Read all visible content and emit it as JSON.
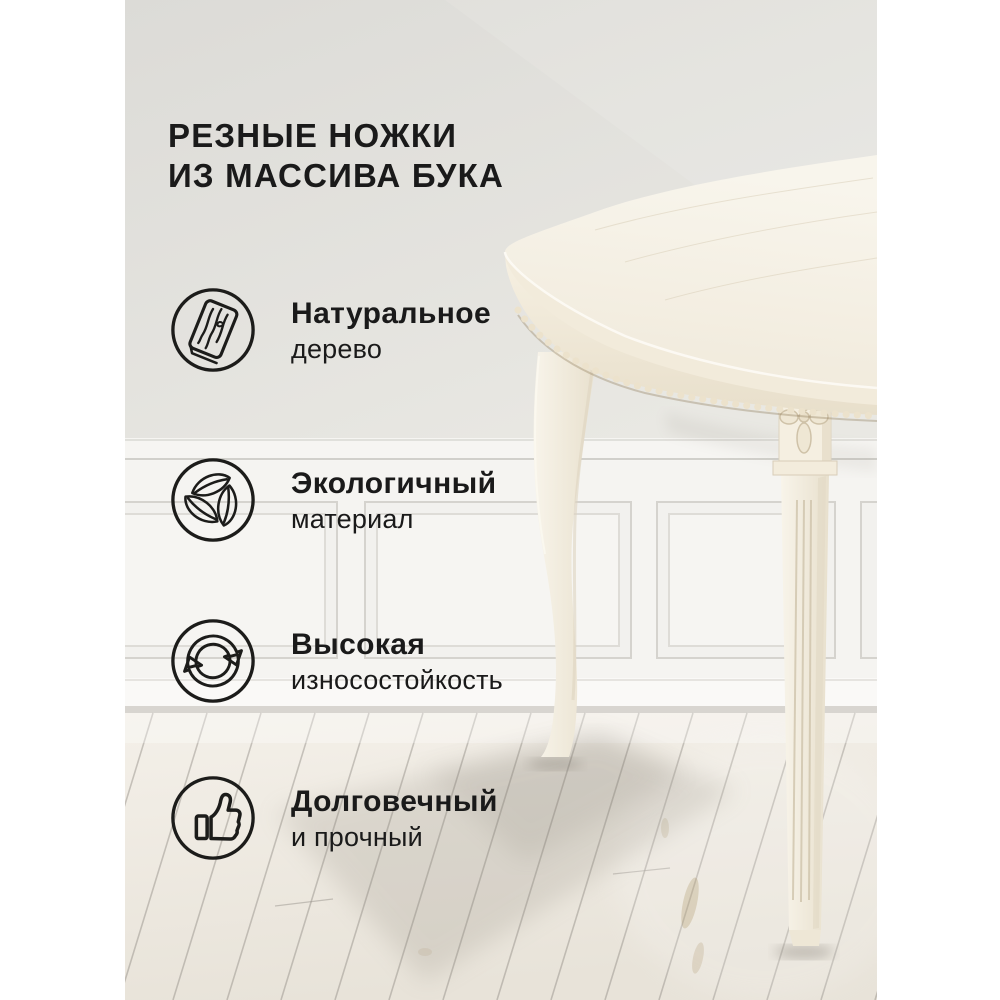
{
  "title": {
    "line1": "РЕЗНЫЕ НОЖКИ",
    "line2": "ИЗ МАССИВА БУКА"
  },
  "features": [
    {
      "icon": "wood-plank-icon",
      "title": "Натуральное",
      "subtitle": "дерево"
    },
    {
      "icon": "eco-leaves-icon",
      "title": "Экологичный",
      "subtitle": "материал"
    },
    {
      "icon": "cycle-arrows-icon",
      "title": "Высокая",
      "subtitle": "износостойкость"
    },
    {
      "icon": "thumbs-up-icon",
      "title": "Долговечный",
      "subtitle": "и прочный"
    }
  ],
  "colors": {
    "canvas": "#ffffff",
    "text": "#1a1a1a",
    "icon_stroke": "#1c1c1a",
    "wall": "#e2e1dd",
    "wainscot": "#f5f4f1",
    "baseboard": "#faf9f7",
    "floor": "#efebe3",
    "table_wood": "#f4efe3"
  }
}
